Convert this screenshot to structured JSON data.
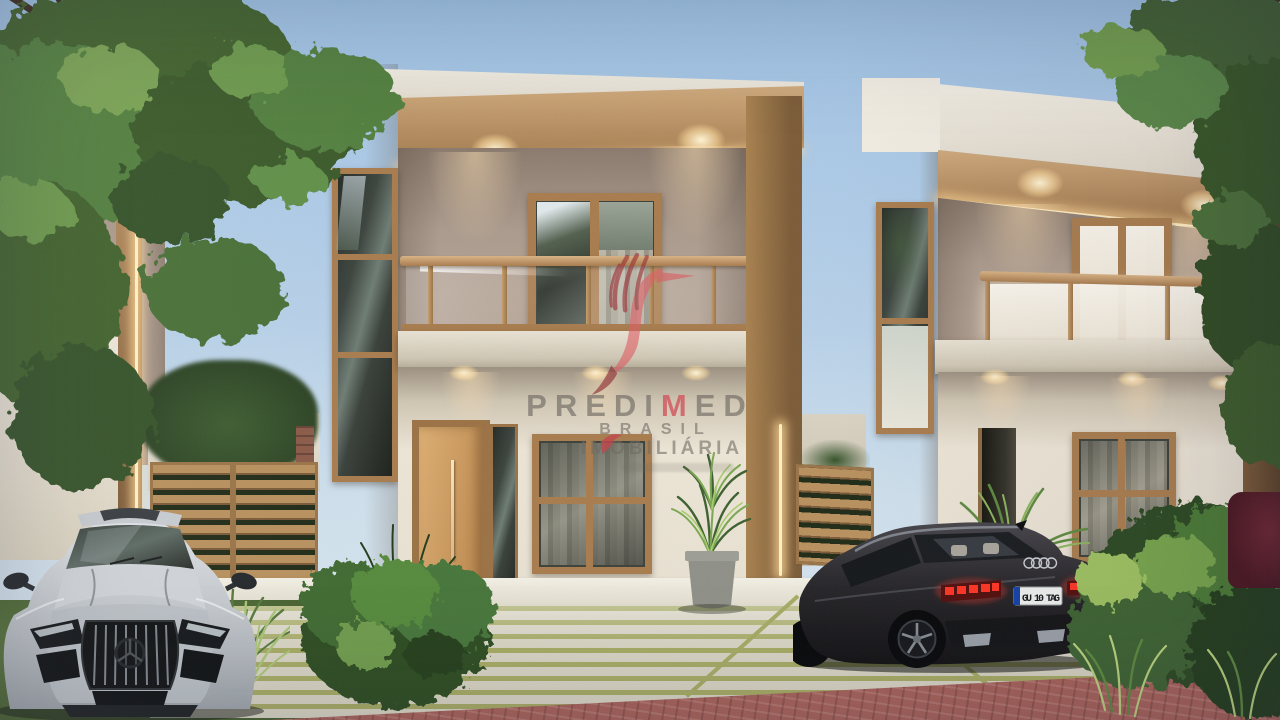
{
  "watermark": {
    "brand_part1": "PREDI",
    "brand_accent": "M",
    "brand_part2": "ED",
    "line2": "BRASIL",
    "line3": "IMOBILIÁRIA",
    "logo_icon": "hummingbird-logo-icon",
    "accent_color": "#d95f63",
    "text_color": "#76716a"
  },
  "vehicles": {
    "silver_sports_car": {
      "badge_icon": "mercedes-star-icon",
      "body_color": "#c6cbd0"
    },
    "black_sedan": {
      "badge_icon": "audi-rings-icon",
      "license_plate": "GU 10 TAG",
      "body_color": "#26262a",
      "taillight_color": "#f03024"
    }
  },
  "palette": {
    "sky_top": "#9fc2e4",
    "sky_bottom": "#cfe0ec",
    "wall_white": "#eae5da",
    "wall_greige": "#b3a294",
    "wood_trim": "#b9905f",
    "led_glow": "#ffe2a8",
    "lawn": "#6f8a4c",
    "grass_strip": "#a6ab64",
    "paver_street": "#a8625a",
    "foliage": "#4c6f38"
  }
}
